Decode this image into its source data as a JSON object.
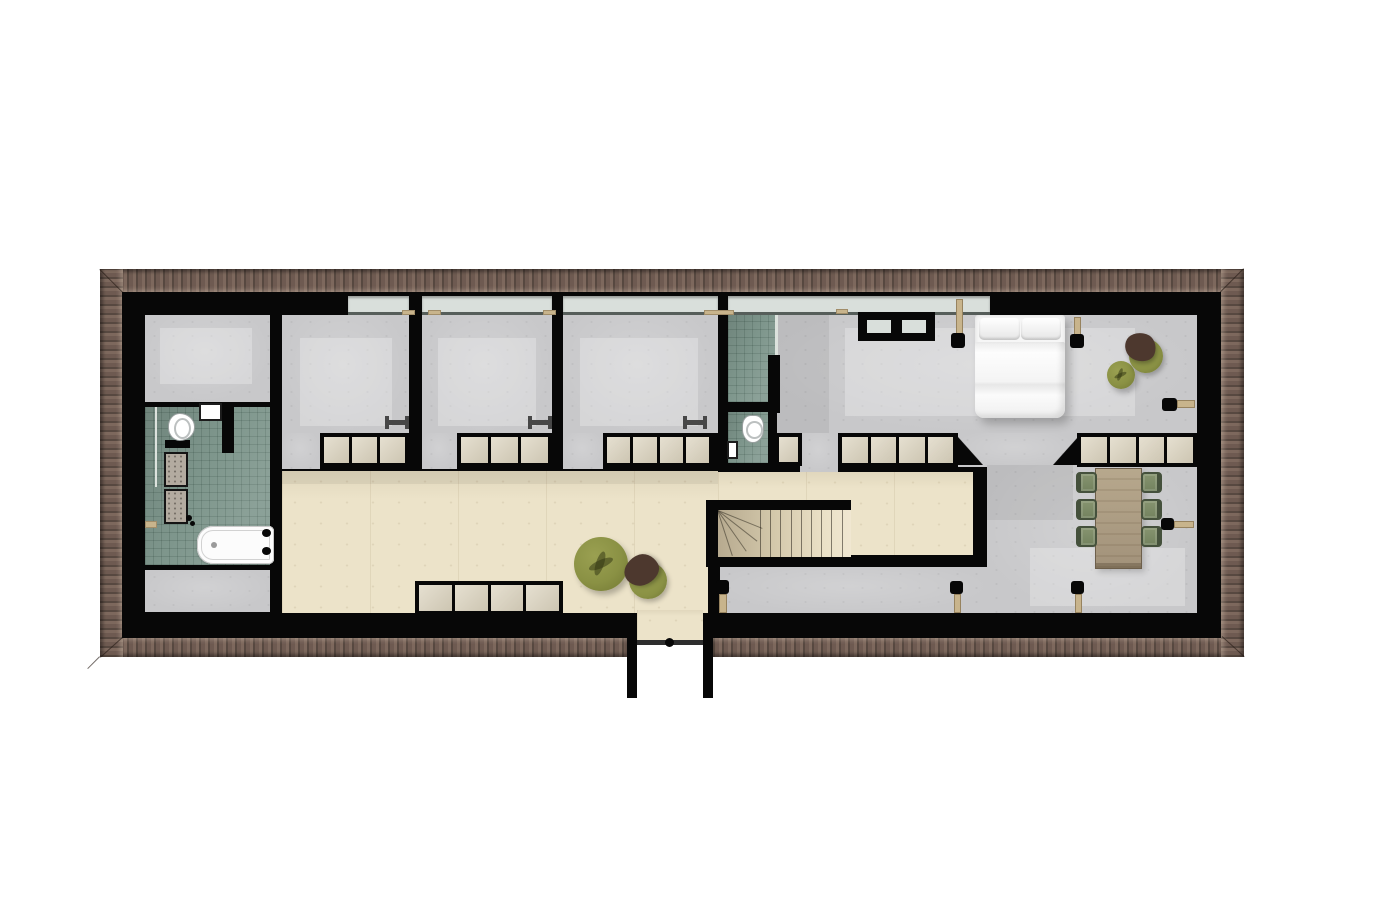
{
  "meta": {
    "kind": "architectural-floor-plan",
    "text_labels": []
  },
  "palette": {
    "wall": "#070707",
    "roof_base": "#6e5a51",
    "roof_dark": "#574840",
    "roof_light": "#7d685d",
    "concrete": "#c8c8ca",
    "tile": "#7e968c",
    "tile_line": "rgba(25,50,40,0.16)",
    "wood": "#ece3c9",
    "closet": "#dcd4bf",
    "glass": "#d9dfdb",
    "olive": "#8a9144",
    "brown": "#4d382e",
    "chair_green": "#7c8b66",
    "chair_line": "#45513c",
    "table_wood": "#b0a189",
    "tan": "#c8b48c",
    "bench": "#474747"
  },
  "inventory": {
    "rooms": [
      "storage-top-left",
      "main-bathroom",
      "storage-bottom-left",
      "bedroom-1",
      "bedroom-2",
      "bedroom-3",
      "shower-room",
      "wc",
      "hallway",
      "master-bedroom",
      "dining-area",
      "stairwell",
      "lower-corridor",
      "balcony-dormer"
    ],
    "furniture": [
      "double-bed",
      "dining-table",
      "dining-chairs-x6",
      "ottoman-x2",
      "lounge-chair-x2",
      "bench-x3",
      "bathtub",
      "vanity-double-sink",
      "toilet-x2",
      "wall-sink-x2",
      "skylight",
      "radiator-x7"
    ],
    "dining_chairs": 6,
    "stair_straight_treads": 10,
    "stair_winder_treads": 4
  },
  "elements": [
    {
      "n": "roof-band-top",
      "c": "roof-top",
      "x": 100,
      "y": 269,
      "w": 1144,
      "h": 24
    },
    {
      "n": "roof-band-bottom-left",
      "c": "roof-bottom",
      "x": 100,
      "y": 637,
      "w": 527,
      "h": 20
    },
    {
      "n": "roof-band-bottom-right",
      "c": "roof-bottom",
      "x": 713,
      "y": 637,
      "w": 531,
      "h": 20
    },
    {
      "n": "roof-band-left",
      "c": "roof-left",
      "x": 100,
      "y": 269,
      "w": 23,
      "h": 388
    },
    {
      "n": "roof-band-right",
      "c": "roof-right",
      "x": 1221,
      "y": 269,
      "w": 23,
      "h": 388
    },
    {
      "n": "roof-miter-tl",
      "c": "miter",
      "x": 100,
      "y": 269,
      "p": {
        "len": 33,
        "ang": 45
      }
    },
    {
      "n": "roof-miter-tr",
      "c": "miter",
      "x": 1244,
      "y": 269,
      "p": {
        "len": 33,
        "ang": 135
      }
    },
    {
      "n": "roof-miter-bl",
      "c": "miter",
      "x": 100,
      "y": 657,
      "p": {
        "len": 30,
        "ang": -42
      }
    },
    {
      "n": "roof-miter-br",
      "c": "miter",
      "x": 1244,
      "y": 657,
      "p": {
        "len": 30,
        "ang": -138
      }
    },
    {
      "n": "eave-line",
      "c": "eave",
      "x": 100,
      "y": 657,
      "p": {
        "len": 17,
        "ang": 135
      }
    },
    {
      "n": "exterior-walls",
      "c": "wall",
      "x": 122,
      "y": 292,
      "w": 1099,
      "h": 346
    },
    {
      "n": "window-band-bedroom-1",
      "c": "window",
      "x": 348,
      "y": 296,
      "w": 61,
      "h": 19
    },
    {
      "n": "window-band-bedroom-2",
      "c": "window",
      "x": 422,
      "y": 296,
      "w": 130,
      "h": 19
    },
    {
      "n": "window-band-bedroom-3",
      "c": "window",
      "x": 563,
      "y": 296,
      "w": 155,
      "h": 19
    },
    {
      "n": "window-band-master",
      "c": "window",
      "x": 728,
      "y": 296,
      "w": 262,
      "h": 19
    },
    {
      "n": "storage-top-left-floor",
      "c": "concrete",
      "x": 145,
      "y": 315,
      "w": 125,
      "h": 87
    },
    {
      "n": "main-bathroom-floor",
      "c": "tile",
      "x": 145,
      "y": 407,
      "w": 125,
      "h": 158
    },
    {
      "n": "storage-bottom-left-floor",
      "c": "concrete",
      "x": 145,
      "y": 570,
      "w": 125,
      "h": 42
    },
    {
      "n": "bedroom-1-floor",
      "c": "concrete",
      "x": 282,
      "y": 315,
      "w": 127,
      "h": 118
    },
    {
      "n": "bedroom-1-doorway",
      "c": "concrete",
      "x": 282,
      "y": 433,
      "w": 38,
      "h": 36
    },
    {
      "n": "bedroom-2-floor",
      "c": "concrete",
      "x": 422,
      "y": 315,
      "w": 130,
      "h": 118
    },
    {
      "n": "bedroom-2-doorway",
      "c": "concrete",
      "x": 422,
      "y": 433,
      "w": 35,
      "h": 36
    },
    {
      "n": "bedroom-3-floor",
      "c": "concrete",
      "x": 563,
      "y": 315,
      "w": 155,
      "h": 118
    },
    {
      "n": "bedroom-3-doorway",
      "c": "concrete",
      "x": 563,
      "y": 433,
      "w": 40,
      "h": 36
    },
    {
      "n": "shower-room-floor",
      "c": "tile",
      "x": 728,
      "y": 315,
      "w": 47,
      "h": 87
    },
    {
      "n": "wc-floor",
      "c": "tile",
      "x": 728,
      "y": 412,
      "w": 40,
      "h": 51
    },
    {
      "n": "master-bedroom-floor",
      "c": "concrete",
      "x": 777,
      "y": 315,
      "w": 420,
      "h": 118
    },
    {
      "n": "master-doorway",
      "c": "concrete",
      "x": 800,
      "y": 433,
      "w": 38,
      "h": 39
    },
    {
      "n": "passage-floor",
      "c": "concrete",
      "x": 958,
      "y": 433,
      "w": 119,
      "h": 34
    },
    {
      "n": "passage-chamfer-left",
      "c": "tri-bl",
      "x": 958,
      "y": 437,
      "w": 25,
      "h": 28
    },
    {
      "n": "passage-chamfer-right",
      "c": "tri-br",
      "x": 1053,
      "y": 437,
      "w": 25,
      "h": 28
    },
    {
      "n": "hallway-floor-left",
      "c": "wood",
      "x": 282,
      "y": 471,
      "w": 436,
      "h": 142
    },
    {
      "n": "hallway-floor-right",
      "c": "wood",
      "x": 718,
      "y": 472,
      "w": 255,
      "h": 83
    },
    {
      "n": "dining-area-floor",
      "c": "concrete",
      "x": 987,
      "y": 465,
      "w": 210,
      "h": 148
    },
    {
      "n": "lower-corridor-floor",
      "c": "concrete",
      "x": 720,
      "y": 567,
      "w": 270,
      "h": 46
    },
    {
      "n": "light-patch-bedroom-1",
      "c": "patch",
      "x": 300,
      "y": 338,
      "w": 92,
      "h": 88
    },
    {
      "n": "light-patch-bedroom-2",
      "c": "patch",
      "x": 438,
      "y": 338,
      "w": 98,
      "h": 88
    },
    {
      "n": "light-patch-bedroom-3",
      "c": "patch",
      "x": 580,
      "y": 338,
      "w": 118,
      "h": 88
    },
    {
      "n": "light-patch-master",
      "c": "patch",
      "x": 845,
      "y": 328,
      "w": 290,
      "h": 88
    },
    {
      "n": "light-patch-storage-top",
      "c": "patch",
      "x": 160,
      "y": 328,
      "w": 92,
      "h": 56
    },
    {
      "n": "light-patch-dining",
      "c": "patch",
      "x": 1030,
      "y": 548,
      "w": 155,
      "h": 58
    },
    {
      "n": "shadow-master-left",
      "c": "shade",
      "x": 777,
      "y": 315,
      "w": 52,
      "h": 118
    },
    {
      "n": "shadow-hallway-top",
      "c": "shade",
      "x": 282,
      "y": 471,
      "w": 436,
      "h": 13
    },
    {
      "n": "shadow-dining-corner",
      "c": "shade",
      "x": 987,
      "y": 465,
      "w": 86,
      "h": 55
    },
    {
      "n": "stair-wall-left",
      "c": "wall",
      "x": 706,
      "y": 500,
      "w": 12,
      "h": 67
    },
    {
      "n": "stair-wall-top",
      "c": "wall",
      "x": 706,
      "y": 500,
      "w": 145,
      "h": 10
    },
    {
      "n": "stair-wall-bottom",
      "c": "wall",
      "x": 706,
      "y": 555,
      "w": 281,
      "h": 12
    },
    {
      "n": "wall-below-stairs",
      "c": "wall",
      "x": 708,
      "y": 567,
      "w": 12,
      "h": 46
    },
    {
      "n": "staircase",
      "c": "stairs",
      "x": 718,
      "y": 510,
      "w": 133,
      "h": 47,
      "p": {
        "lines": 9,
        "start": 42,
        "step": 10.2,
        "winders": [
          [
            22,
            48
          ],
          [
            38,
            50
          ],
          [
            55,
            50
          ],
          [
            72,
            48
          ]
        ]
      }
    },
    {
      "n": "shower-glass-screen",
      "c": "glass",
      "x": 775,
      "y": 315,
      "w": 3,
      "h": 40
    },
    {
      "n": "wall-stub-shower",
      "c": "wall",
      "x": 768,
      "y": 355,
      "w": 12,
      "h": 58
    },
    {
      "n": "bath-partition-a",
      "c": "wall",
      "x": 222,
      "y": 407,
      "w": 12,
      "h": 46
    },
    {
      "n": "bath-partition-b",
      "c": "wall",
      "x": 165,
      "y": 440,
      "w": 25,
      "h": 8
    },
    {
      "n": "bath-glass-screen",
      "c": "glass",
      "x": 155,
      "y": 407,
      "w": 2,
      "h": 80
    },
    {
      "n": "closet-bedroom-1",
      "c": "closet-row",
      "x": 320,
      "y": 433,
      "w": 89,
      "h": 34,
      "p": {
        "doors": 3
      }
    },
    {
      "n": "closet-bedroom-2",
      "c": "closet-row",
      "x": 457,
      "y": 433,
      "w": 95,
      "h": 34,
      "p": {
        "doors": 3
      }
    },
    {
      "n": "closet-bedroom-3",
      "c": "closet-row",
      "x": 603,
      "y": 433,
      "w": 110,
      "h": 34,
      "p": {
        "doors": 4
      }
    },
    {
      "n": "closet-master-a",
      "c": "closet-row",
      "x": 775,
      "y": 433,
      "w": 27,
      "h": 33,
      "p": {
        "doors": 1
      }
    },
    {
      "n": "closet-master-b",
      "c": "closet-row",
      "x": 838,
      "y": 433,
      "w": 119,
      "h": 34,
      "p": {
        "doors": 4
      }
    },
    {
      "n": "closet-master-c",
      "c": "closet-row",
      "x": 1077,
      "y": 433,
      "w": 120,
      "h": 34,
      "p": {
        "doors": 4
      }
    },
    {
      "n": "closet-hallway",
      "c": "closet-row",
      "x": 415,
      "y": 581,
      "w": 148,
      "h": 34,
      "p": {
        "doors": 4
      }
    },
    {
      "n": "balcony-floor",
      "c": "wood",
      "x": 637,
      "y": 610,
      "w": 66,
      "h": 31
    },
    {
      "n": "balcony-door",
      "c": "doorline",
      "x": 637,
      "y": 640,
      "w": 66,
      "h": 5
    },
    {
      "n": "balcony-door-handle",
      "c": "dot",
      "x": 665,
      "y": 638,
      "w": 9,
      "h": 9
    },
    {
      "n": "dormer-wall-left",
      "c": "wall",
      "x": 627,
      "y": 634,
      "w": 10,
      "h": 64
    },
    {
      "n": "dormer-wall-right",
      "c": "wall",
      "x": 703,
      "y": 634,
      "w": 10,
      "h": 64
    },
    {
      "n": "skylight",
      "c": "skylight",
      "x": 858,
      "y": 312,
      "w": 77,
      "h": 29
    },
    {
      "n": "double-bed",
      "c": "bed",
      "x": 975,
      "y": 315,
      "w": 90,
      "h": 103
    },
    {
      "n": "bench-bedroom-1",
      "c": "bench",
      "x": 385,
      "y": 416,
      "w": 24,
      "h": 13
    },
    {
      "n": "bench-bedroom-2",
      "c": "bench",
      "x": 528,
      "y": 416,
      "w": 24,
      "h": 13
    },
    {
      "n": "bench-bedroom-3",
      "c": "bench",
      "x": 683,
      "y": 416,
      "w": 24,
      "h": 13
    },
    {
      "n": "ottoman-hallway",
      "c": "pouf",
      "x": 574,
      "y": 537,
      "w": 54,
      "h": 54
    },
    {
      "n": "lounge-chair-hallway",
      "c": "blob-chair",
      "x": 629,
      "y": 562,
      "w": 38,
      "h": 37,
      "p": {
        "rot": -28
      }
    },
    {
      "n": "ottoman-master",
      "c": "pouf",
      "x": 1107,
      "y": 361,
      "w": 28,
      "h": 28
    },
    {
      "n": "lounge-chair-master",
      "c": "blob-chair",
      "x": 1129,
      "y": 339,
      "w": 34,
      "h": 34,
      "p": {
        "rot": 18
      }
    },
    {
      "n": "dining-table",
      "c": "table",
      "x": 1095,
      "y": 468,
      "w": 47,
      "h": 101
    },
    {
      "n": "dining-chair-1",
      "c": "chair",
      "x": 1076,
      "y": 472,
      "w": 21,
      "h": 21,
      "p": {
        "side": "cl"
      }
    },
    {
      "n": "dining-chair-2",
      "c": "chair",
      "x": 1076,
      "y": 499,
      "w": 21,
      "h": 21,
      "p": {
        "side": "cl"
      }
    },
    {
      "n": "dining-chair-3",
      "c": "chair",
      "x": 1076,
      "y": 526,
      "w": 21,
      "h": 21,
      "p": {
        "side": "cl"
      }
    },
    {
      "n": "dining-chair-4",
      "c": "chair",
      "x": 1141,
      "y": 472,
      "w": 21,
      "h": 21,
      "p": {
        "side": "cr"
      }
    },
    {
      "n": "dining-chair-5",
      "c": "chair",
      "x": 1141,
      "y": 499,
      "w": 21,
      "h": 21,
      "p": {
        "side": "cr"
      }
    },
    {
      "n": "dining-chair-6",
      "c": "chair",
      "x": 1141,
      "y": 526,
      "w": 21,
      "h": 21,
      "p": {
        "side": "cr"
      }
    },
    {
      "n": "radiator-window-1-bar",
      "c": "rad-bar",
      "x": 956,
      "y": 299,
      "w": 7,
      "h": 36
    },
    {
      "n": "radiator-window-1-cap",
      "c": "rad-cap",
      "x": 951,
      "y": 333,
      "w": 14,
      "h": 15
    },
    {
      "n": "radiator-window-2-bar",
      "c": "rad-bar",
      "x": 1074,
      "y": 317,
      "w": 7,
      "h": 19
    },
    {
      "n": "radiator-window-2-cap",
      "c": "rad-cap",
      "x": 1070,
      "y": 334,
      "w": 14,
      "h": 14
    },
    {
      "n": "radiator-master-bar",
      "c": "rad-bar",
      "x": 1177,
      "y": 400,
      "w": 18,
      "h": 8
    },
    {
      "n": "radiator-master-cap",
      "c": "rad-cap",
      "x": 1162,
      "y": 398,
      "w": 15,
      "h": 13
    },
    {
      "n": "radiator-dining-bar",
      "c": "rad-bar",
      "x": 1174,
      "y": 521,
      "w": 20,
      "h": 7
    },
    {
      "n": "radiator-dining-cap",
      "c": "rad-cap",
      "x": 1161,
      "y": 518,
      "w": 13,
      "h": 12
    },
    {
      "n": "radiator-corridor-1-bar",
      "c": "rad-bar",
      "x": 719,
      "y": 594,
      "w": 8,
      "h": 19
    },
    {
      "n": "radiator-corridor-1-cap",
      "c": "rad-cap",
      "x": 716,
      "y": 580,
      "w": 13,
      "h": 14
    },
    {
      "n": "radiator-corridor-2-bar",
      "c": "rad-bar",
      "x": 954,
      "y": 594,
      "w": 7,
      "h": 19
    },
    {
      "n": "radiator-corridor-2-cap",
      "c": "rad-cap",
      "x": 950,
      "y": 581,
      "w": 13,
      "h": 13
    },
    {
      "n": "radiator-corridor-3-bar",
      "c": "rad-bar",
      "x": 1075,
      "y": 594,
      "w": 7,
      "h": 19
    },
    {
      "n": "radiator-corridor-3-cap",
      "c": "rad-cap",
      "x": 1071,
      "y": 581,
      "w": 13,
      "h": 13
    },
    {
      "n": "window-handle-1",
      "c": "tan",
      "x": 402,
      "y": 310,
      "w": 13,
      "h": 5
    },
    {
      "n": "window-handle-2",
      "c": "tan",
      "x": 428,
      "y": 310,
      "w": 13,
      "h": 5
    },
    {
      "n": "window-handle-3",
      "c": "tan",
      "x": 543,
      "y": 310,
      "w": 13,
      "h": 5
    },
    {
      "n": "window-sill-master",
      "c": "tan",
      "x": 704,
      "y": 310,
      "w": 30,
      "h": 5
    },
    {
      "n": "window-handle-4",
      "c": "tan",
      "x": 836,
      "y": 309,
      "w": 12,
      "h": 5
    },
    {
      "n": "shelf-tick-left-wall",
      "c": "tan",
      "x": 145,
      "y": 521,
      "w": 12,
      "h": 7
    },
    {
      "n": "toilet-main-bathroom",
      "c": "toilet toilet-r",
      "x": 168,
      "y": 413,
      "w": 27,
      "h": 28
    },
    {
      "n": "wall-sink-main-bathroom",
      "c": "sink",
      "x": 199,
      "y": 403,
      "w": 23,
      "h": 18
    },
    {
      "n": "vanity-sink-1",
      "c": "sink-t",
      "x": 164,
      "y": 452,
      "w": 24,
      "h": 35
    },
    {
      "n": "vanity-sink-2",
      "c": "sink-t",
      "x": 164,
      "y": 489,
      "w": 24,
      "h": 35
    },
    {
      "n": "vanity-faucet-1",
      "c": "dot",
      "x": 186,
      "y": 515,
      "w": 6,
      "h": 6
    },
    {
      "n": "vanity-faucet-2",
      "c": "dot",
      "x": 190,
      "y": 521,
      "w": 5,
      "h": 5
    },
    {
      "n": "bathtub",
      "c": "tub",
      "x": 197,
      "y": 526,
      "w": 77,
      "h": 38
    },
    {
      "n": "tub-faucet-1",
      "c": "dot",
      "x": 262,
      "y": 529,
      "w": 9,
      "h": 8
    },
    {
      "n": "tub-faucet-2",
      "c": "dot",
      "x": 262,
      "y": 547,
      "w": 9,
      "h": 8
    },
    {
      "n": "toilet-wc",
      "c": "toilet toilet-d",
      "x": 742,
      "y": 415,
      "w": 22,
      "h": 28
    },
    {
      "n": "wall-sink-wc",
      "c": "sink",
      "x": 727,
      "y": 441,
      "w": 11,
      "h": 18
    }
  ]
}
